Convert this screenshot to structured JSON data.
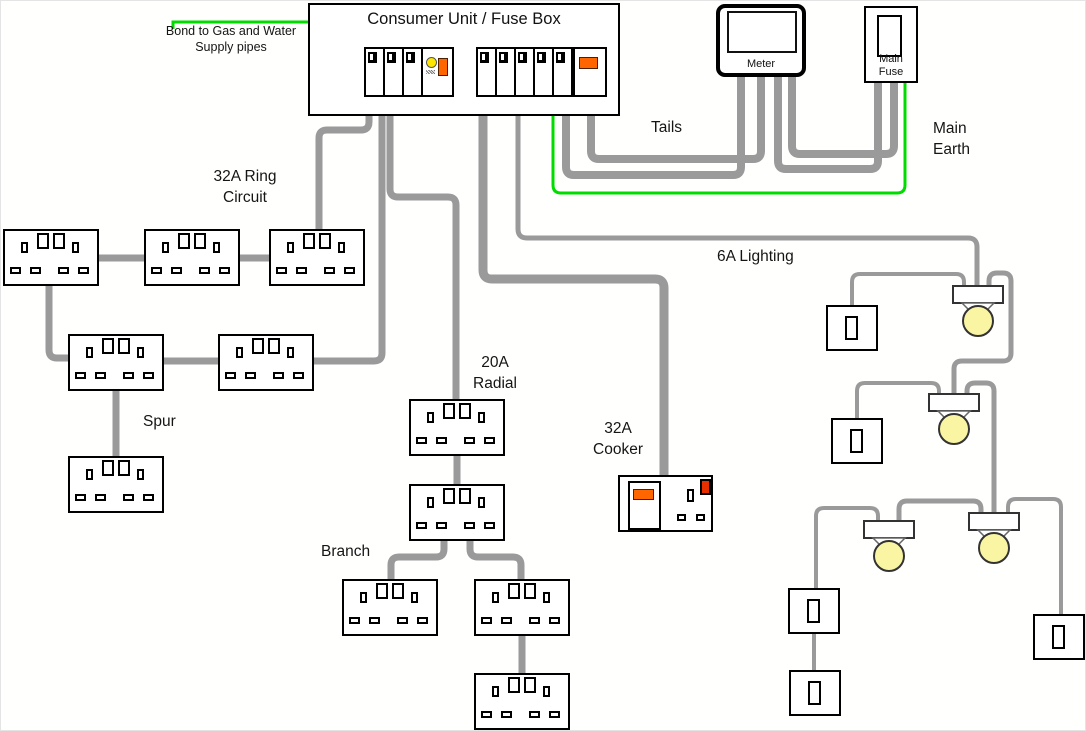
{
  "consumer_unit": {
    "title": "Consumer Unit / Fuse Box"
  },
  "meter": {
    "label": "Meter"
  },
  "main_fuse": {
    "label": "Main\nFuse"
  },
  "annotations": {
    "bond": "Bond to Gas and Water\nSupply pipes",
    "tails": "Tails",
    "main_earth": "Main\nEarth",
    "ring_circuit": "32A Ring\nCircuit",
    "spur": "Spur",
    "radial": "20A\nRadial",
    "branch": "Branch",
    "cooker": "32A\nCooker",
    "lighting": "6A Lighting"
  },
  "colors": {
    "wire": "#9a9a9a",
    "earth": "#00dc00",
    "switch_orange": "#ff6600",
    "test_button_yellow": "#ffe600",
    "bulb_yellow": "#faf5a3",
    "neon_red": "#e63000"
  }
}
